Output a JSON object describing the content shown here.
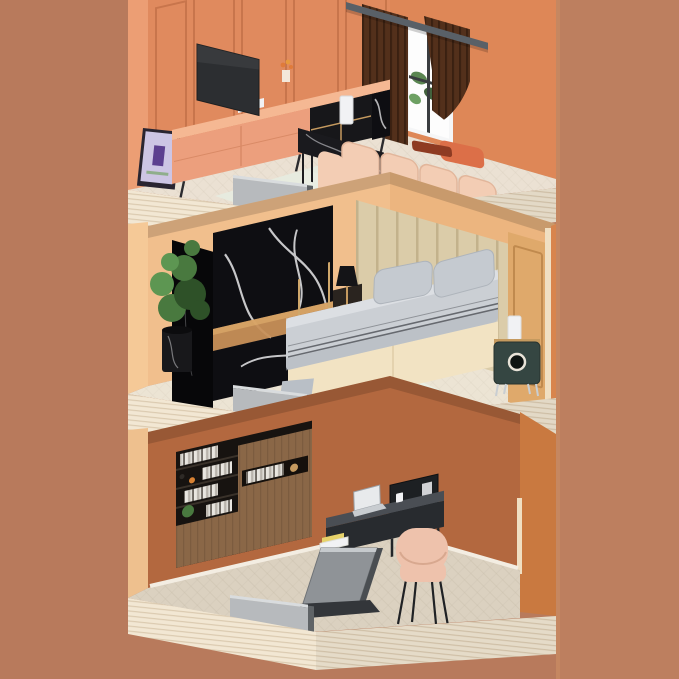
{
  "scene": {
    "kind": "isometric-cutaway-3d-interior-render",
    "floors": [
      {
        "name": "living-room",
        "level": "top",
        "objects": [
          "paneled-accent-wall",
          "wall-tv",
          "tv-console",
          "flower-vase",
          "magazine",
          "leaning-poster",
          "window",
          "window-plant",
          "curtain-left",
          "curtain-right",
          "curtain-rod",
          "modular-sofa",
          "orange-throw-pillow",
          "coffee-table",
          "humidifier",
          "area-rug",
          "floor-edge-panel"
        ]
      },
      {
        "name": "bedroom",
        "level": "middle",
        "objects": [
          "black-marble-wardrobe",
          "potted-plant",
          "platform-bed",
          "bed-pillows",
          "striped-blanket",
          "black-table-lamp",
          "bedside-cabinet",
          "padded-headboard-wall",
          "molding-wall-panel",
          "teal-nightstand",
          "cylinder-lamp",
          "area-rug",
          "floor-edge-panel"
        ]
      },
      {
        "name": "home-office",
        "level": "bottom",
        "objects": [
          "bookshelf",
          "book-spines",
          "walnut-cabinet-doors",
          "shelf-plant",
          "desk",
          "desk-riser",
          "laptop",
          "paper-stack",
          "cup",
          "z-leg-panel",
          "desk-chair",
          "baseboard",
          "floor-edge-panel"
        ]
      }
    ]
  },
  "palette": {
    "bg": "#b87a5c",
    "bg-right": "#bd7f5f",
    "bg-right-edge": "#c98a62",
    "outer-top": "#ec9e74",
    "wall-a": "#e08a5e",
    "wall-a-line": "#c06f46",
    "wall-b": "#de8757",
    "mid-outer": "#f5c997",
    "wall-mid": "#f1bf8d",
    "wall-mid2": "#ecb57f",
    "panel-tan": "#dfa96b",
    "panel-tan-line": "#c08a4e",
    "headboard-a": "#dbcca9",
    "headboard-b": "#c3b28c",
    "mid-right-outer": "#d8854d",
    "corner-cream": "#f0dfc2",
    "wall-bot": "#b3683f",
    "bot-right": "#c97940",
    "baseboard": "#f3ede2",
    "slab": "#f2e7d3",
    "slab-line": "#d9c8ad",
    "floor-top": "#ebe1d3",
    "floor-mid": "#ece4d4",
    "floor-bot": "#dbd1c0",
    "floor-line": "#b9ad99",
    "gray-panel": "#b7babd",
    "gray-panel-side": "#5f6366",
    "gray-panel-top": "#d9dcde",
    "tv": "#2c2e31",
    "console": "#ec9f7d",
    "console-top": "#f5b893",
    "console-dark": "#17171a",
    "gold": "#c59a5f",
    "bronze": "#c89058",
    "marble-black": "#0e0e12",
    "marble-vein": "#e8e8ea",
    "poster-bg": "#cdc5e4",
    "poster-fig": "#5c3f8f",
    "frame-dark": "#2a2531",
    "window-frame": "#f5f6f7",
    "window-glass": "#fdfdfd",
    "plant-green": "#49793f",
    "plant-dark": "#2e5128",
    "plant-light": "#5d9652",
    "curtain": "#53301b",
    "curtain-dark": "#3a2011",
    "rod": "#596067",
    "sofa": "#f3cdb4",
    "sofa-dark": "#e2b69b",
    "pillow-orange": "#dc6f48",
    "pillow-rust": "#8e3b22",
    "table-black": "#1a1a1e",
    "white": "#f1f2f4",
    "rug-top": "#e7ebdf",
    "rug-mid": "#e9efe4",
    "rug-green": "#9fc49a",
    "bed-base": "#f2e3c3",
    "bed-base-line": "#dfcda8",
    "bedding": "#cbcfd4",
    "bedding-dark": "#aeb3ba",
    "sheet-light": "#e3e6ea",
    "pillow-gray": "#c5cad0",
    "stripe-dark": "#55585e",
    "lamp-black": "#141417",
    "nightstand": "#354642",
    "chrome": "#c9ced2",
    "books-dark": "#171310",
    "shelf-line": "#3a322a",
    "wood-walnut": "#8a6747",
    "walnut-line": "#5d4430",
    "desk-dark": "#282b2f",
    "desk-top": "#4a4e54",
    "desk-gray": "#8f9397",
    "desk-gray-dark": "#4a4e52",
    "chair": "#eec2ac",
    "chair-dark": "#d8a88f",
    "leg-dark": "#1f2124",
    "paper-yellow": "#e6d26a",
    "shadow": "#000000"
  }
}
